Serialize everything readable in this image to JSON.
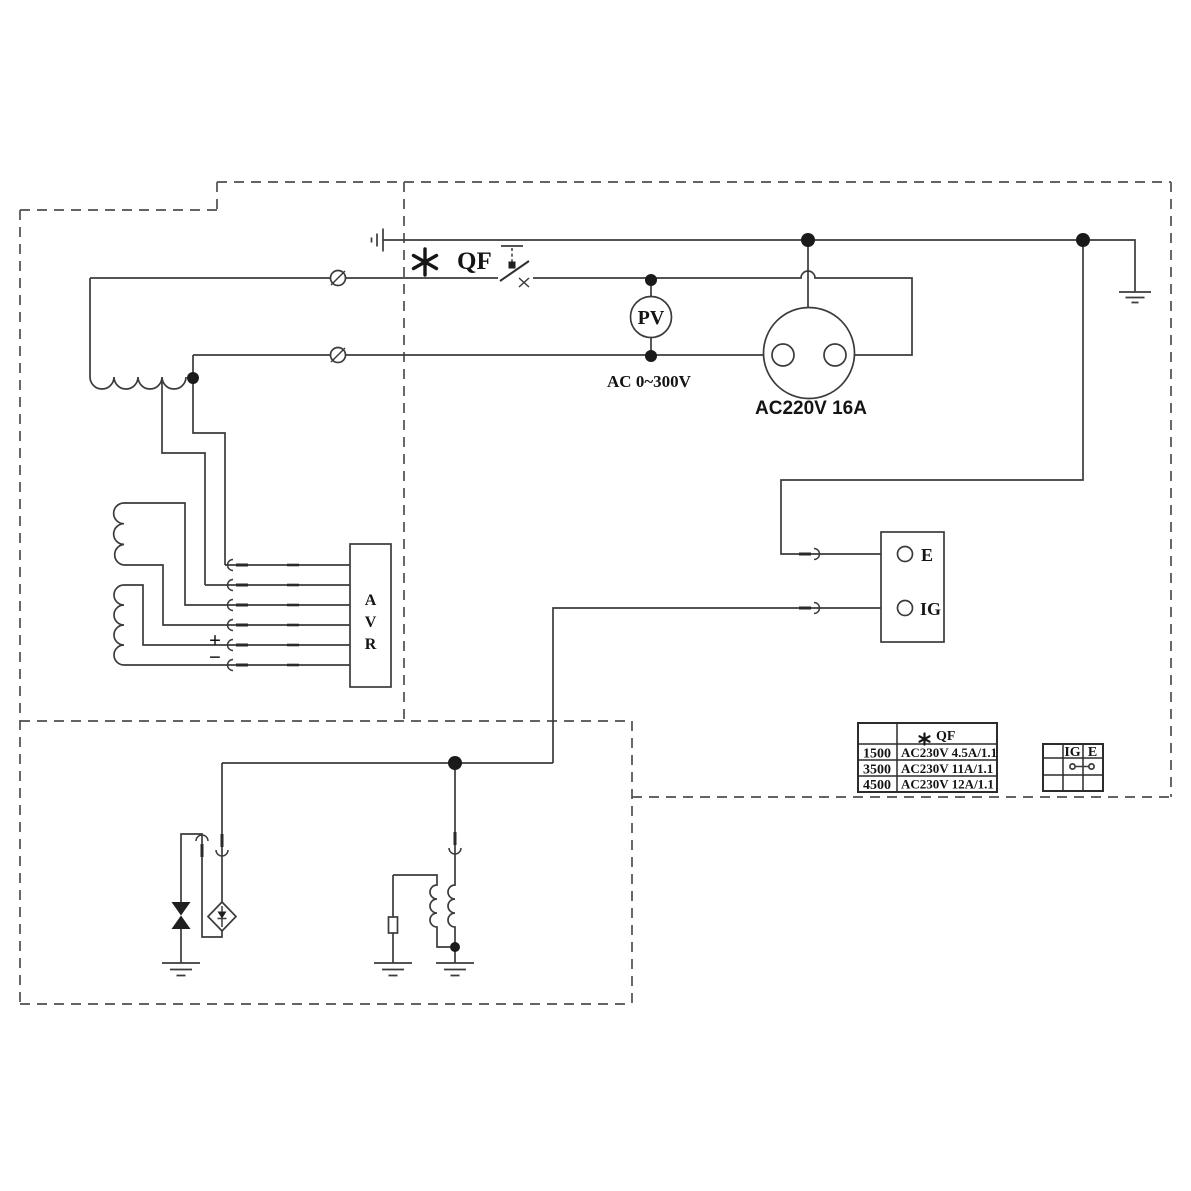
{
  "colors": {
    "line": "#3b3b3b",
    "text": "#141414",
    "background": "#ffffff"
  },
  "schematic": {
    "breaker": {
      "asterisk": "*",
      "label": "QF"
    },
    "voltmeter": {
      "label": "PV",
      "range": "AC 0~300V"
    },
    "socket": {
      "label": "AC220V 16A"
    },
    "terminals": {
      "e": "E",
      "ig": "IG"
    },
    "avr": {
      "letters": [
        "A",
        "V",
        "R"
      ]
    },
    "polarity": {
      "plus": "+",
      "minus": "−"
    },
    "qf_table": {
      "header_symbol": "*",
      "header": "QF",
      "rows": [
        {
          "model": "1500",
          "spec": "AC230V 4.5A/1.1"
        },
        {
          "model": "3500",
          "spec": "AC230V 11A/1.1"
        },
        {
          "model": "4500",
          "spec": "AC230V 12A/1.1"
        }
      ]
    },
    "switch_table": {
      "col_ig": "IG",
      "col_e": "E"
    }
  }
}
